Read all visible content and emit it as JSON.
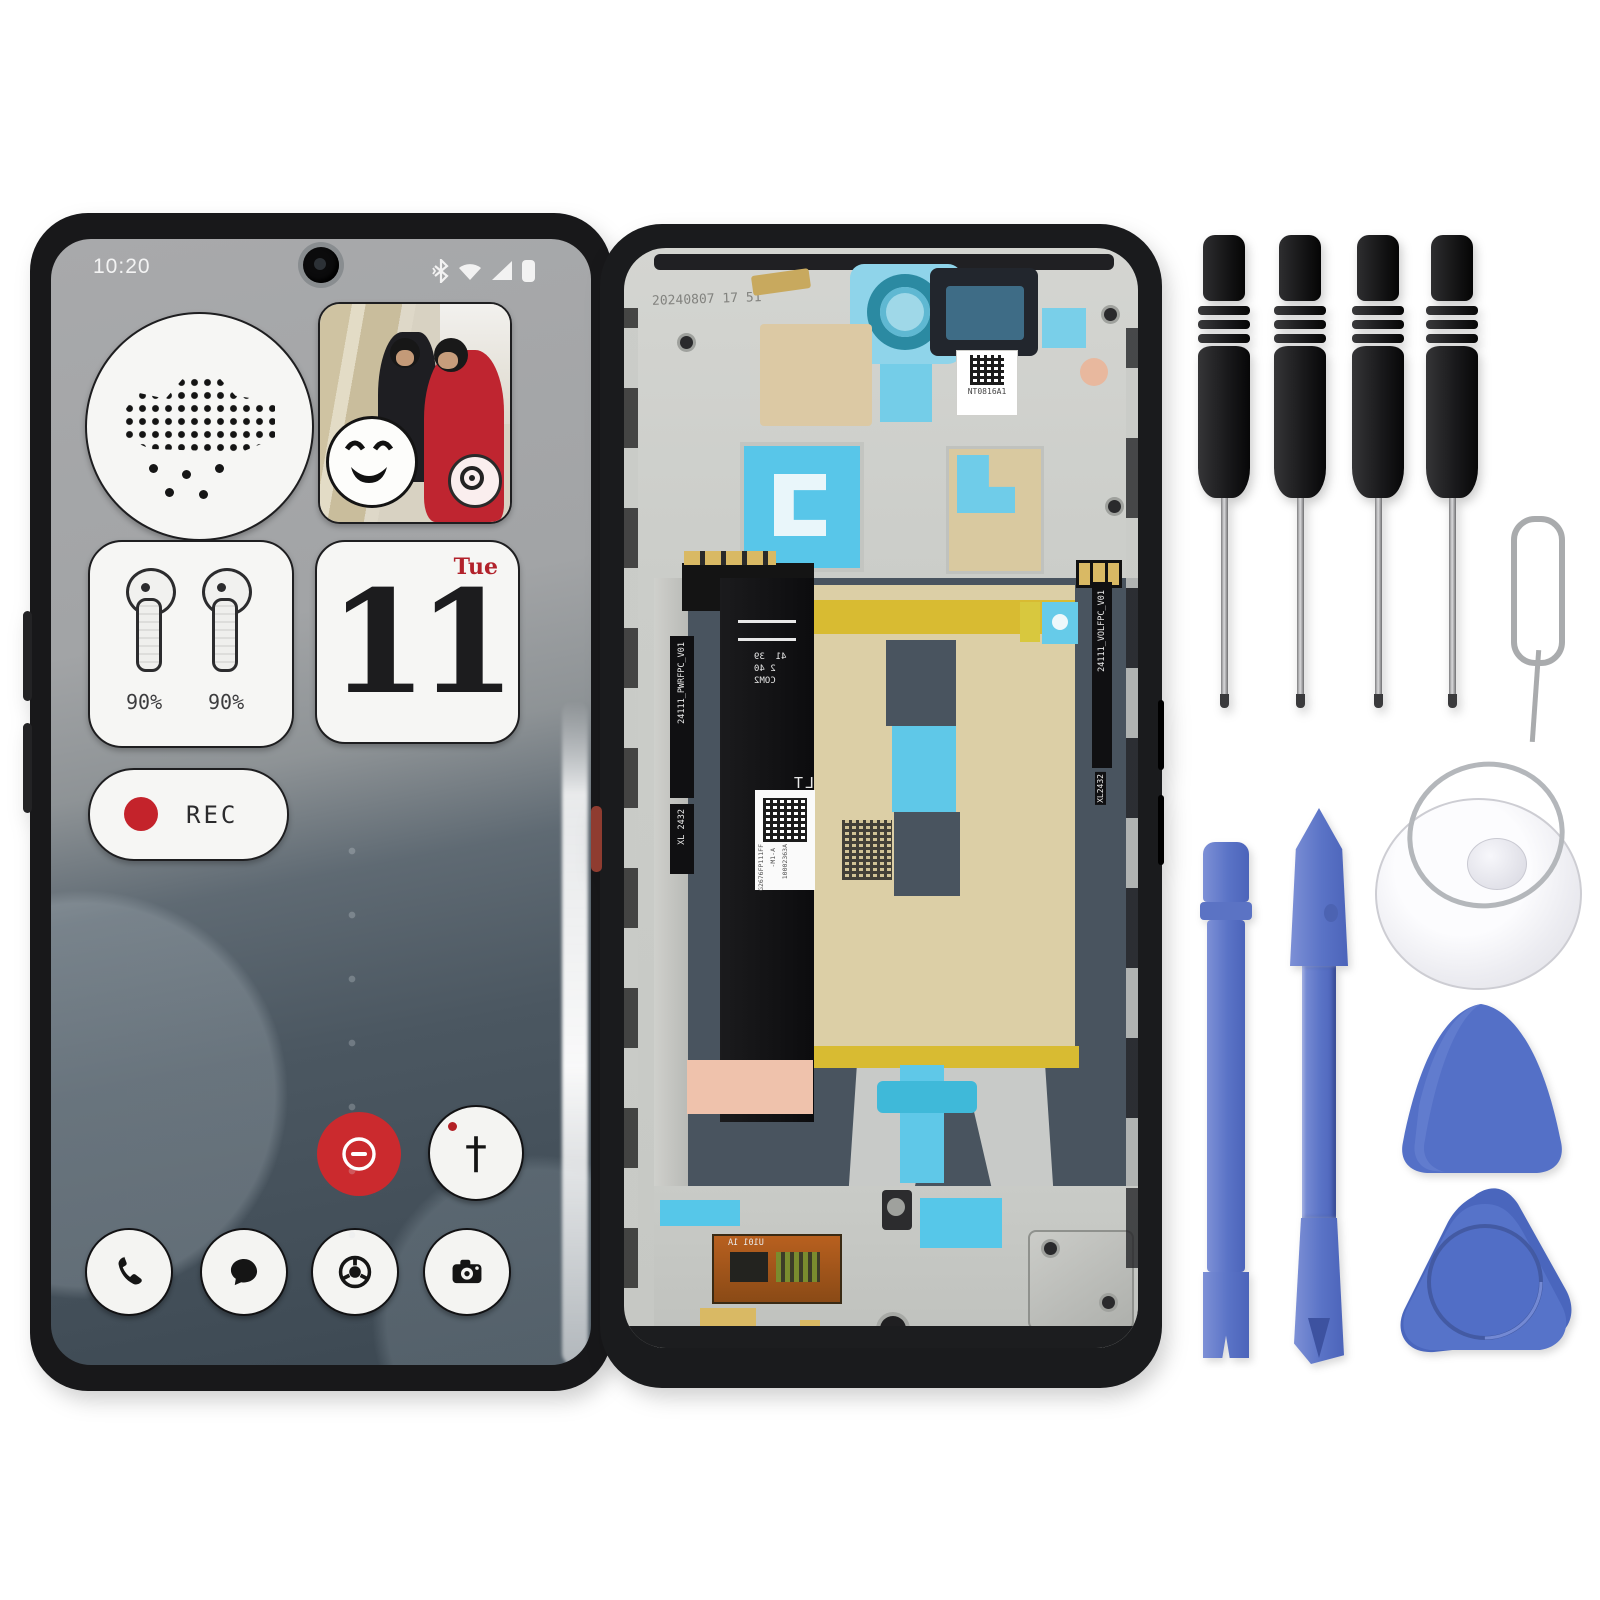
{
  "phone_front": {
    "status": {
      "time": "10:20"
    },
    "widgets": {
      "earbuds": {
        "left": "90%",
        "right": "90%"
      },
      "calendar": {
        "weekday": "Tue",
        "day": "11"
      },
      "recorder": {
        "label": "REC"
      }
    },
    "icons": {
      "person_glyph": "†"
    }
  },
  "phone_back": {
    "etched_date": "20240807 17 51",
    "qr_label": "NT0816A1",
    "left_flex": {
      "part": "24111_PWRFPC_V01",
      "batch": "XL 2432"
    },
    "right_flex": {
      "part": "24111_VOLFPC_V01",
      "batch": "XL2432"
    },
    "main_flex": {
      "mark": "LT 2443",
      "conn_a": "41  39",
      "conn_b": "2   40",
      "conn_label": "COM2",
      "label_line1": "G2676FP111FF",
      "label_line2": "-M1-A",
      "label_line3": "10002363A"
    },
    "bottom_flex": {
      "mark": "U101 1A"
    }
  },
  "colors": {
    "accent_red": "#c8262c",
    "tool_blue": "#5a73c6",
    "tape_cyan": "#55c6e8",
    "sticker_tan": "#dccfa6",
    "tape_yellow": "#d8bb32",
    "slate_gray": "#49545f"
  }
}
